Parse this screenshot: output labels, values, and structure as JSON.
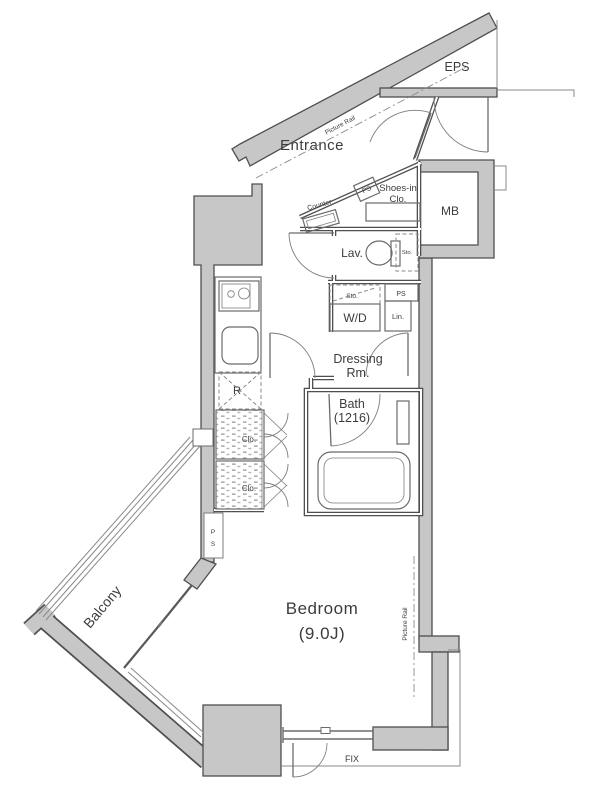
{
  "document_type": "apartment-floor-plan",
  "colors": {
    "background": "#ffffff",
    "wall_fill": "#c7c7c7",
    "wall_outline": "#4f4f4f",
    "thin_line": "#8a8a8a",
    "text": "#3c3c3c"
  },
  "rooms": {
    "entrance": "Entrance",
    "eps": "EPS",
    "mb": "MB",
    "lavatory": "Lav.",
    "dressing_line1": "Dressing",
    "dressing_line2": "Rm.",
    "bath_line1": "Bath",
    "bath_line2": "(1216)",
    "bedroom_line1": "Bedroom",
    "bedroom_line2": "(9.0J)",
    "balcony": "Balcony"
  },
  "labels": {
    "picture_rail_diagonal": "Picture Rail",
    "picture_rail_vertical": "Picture Rail",
    "ps_entrance": "PS",
    "ps_utility": "PS",
    "ps_wall_letter1": "P",
    "ps_wall_letter2": "S",
    "shoes_closet_line1": "Shoes-in",
    "shoes_closet_line2": "Clo.",
    "counter": "Counter",
    "sto_toilet": "Sto.",
    "sto_washer": "Sto.",
    "washer_dryer": "W/D",
    "linen": "Lin.",
    "refrigerator": "R",
    "closet_upper": "Clo.",
    "closet_lower": "Clo.",
    "fix_window": "FIX"
  }
}
